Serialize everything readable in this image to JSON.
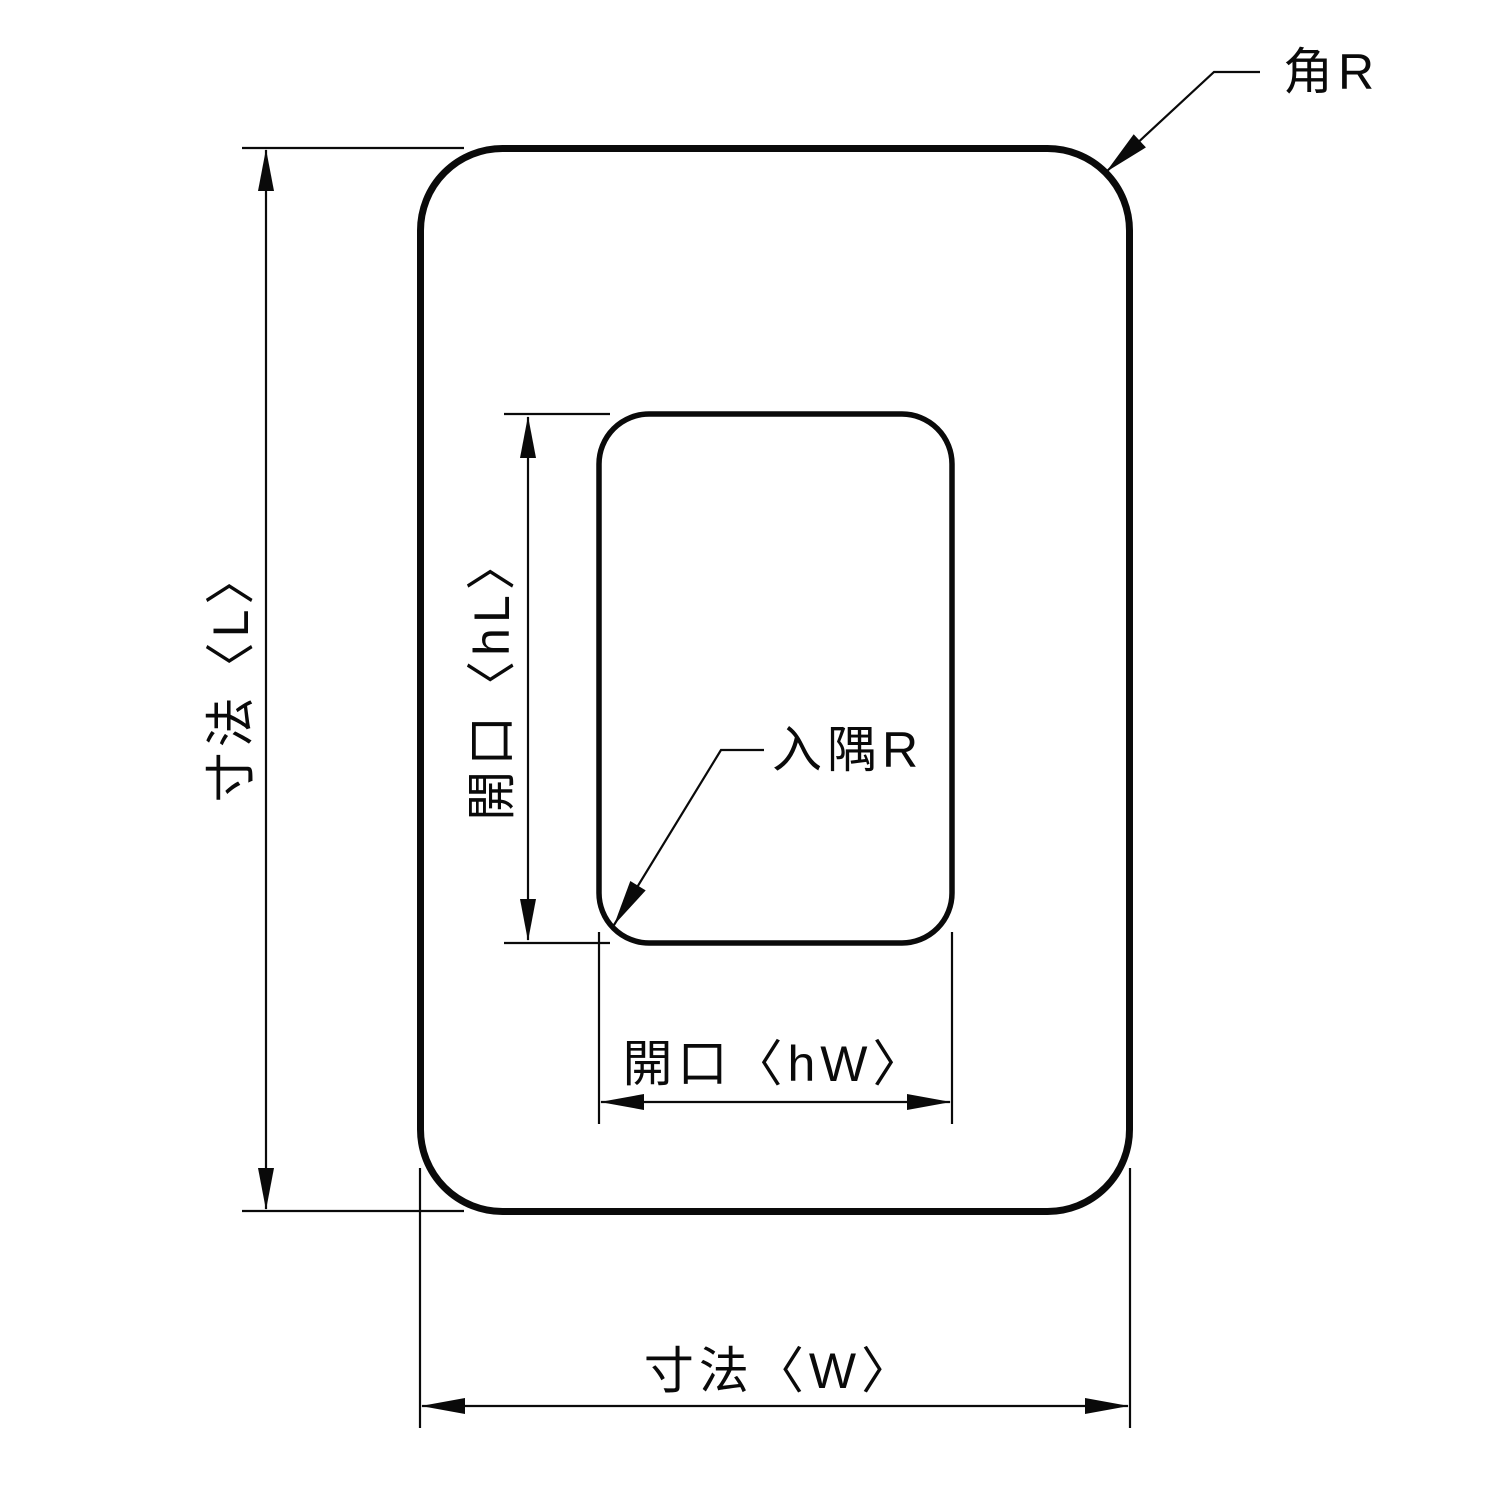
{
  "drawing": {
    "labels": {
      "corner_radius": "角R",
      "length": "寸法〈L〉",
      "opening_length": "開口〈hL〉",
      "inner_corner_radius": "入隅R",
      "opening_width": "開口〈hW〉",
      "width": "寸法〈W〉"
    },
    "colors": {
      "line": "#0a0a0a",
      "background": "#ffffff"
    }
  }
}
